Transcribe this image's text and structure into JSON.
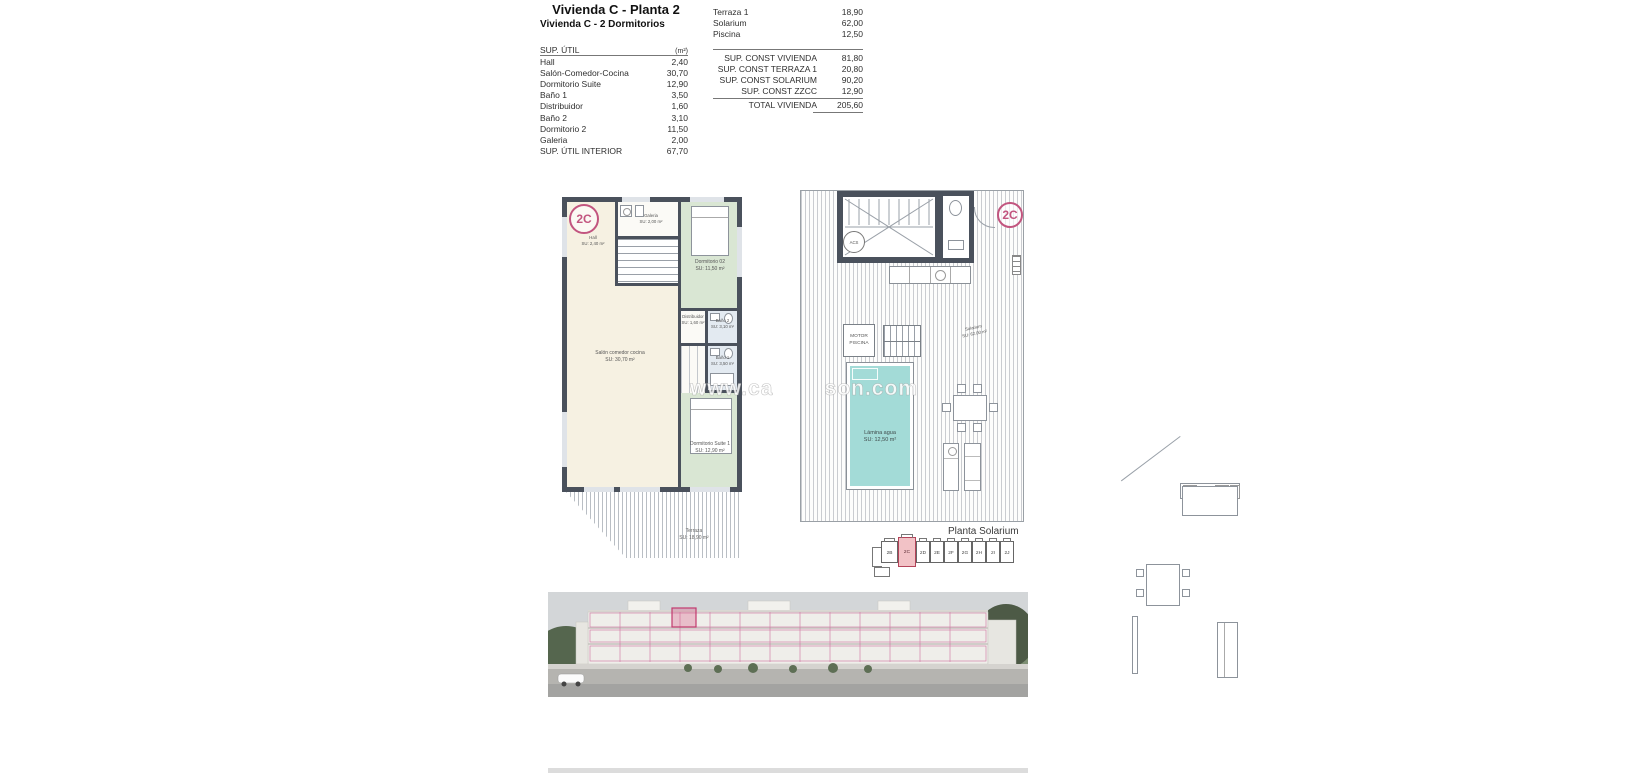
{
  "header": {
    "title": "Vivienda C - Planta 2",
    "subtitle": "Vivienda C - 2 Dormitorios"
  },
  "sup_util_table": {
    "header": {
      "label": "SUP. ÚTIL",
      "unit": "(m²)"
    },
    "rows": [
      {
        "label": "Hall",
        "value": "2,40"
      },
      {
        "label": "Salón-Comedor-Cocina",
        "value": "30,70"
      },
      {
        "label": "Dormitorio Suite",
        "value": "12,90"
      },
      {
        "label": "Baño 1",
        "value": "3,50"
      },
      {
        "label": "Distribuidor",
        "value": "1,60"
      },
      {
        "label": "Baño 2",
        "value": "3,10"
      },
      {
        "label": "Dormitorio 2",
        "value": "11,50"
      },
      {
        "label": "Galeria",
        "value": "2,00"
      },
      {
        "label": "SUP. ÚTIL INTERIOR",
        "value": "67,70"
      }
    ]
  },
  "exterior_table": {
    "rows": [
      {
        "label": "Terraza 1",
        "value": "18,90"
      },
      {
        "label": "Solarium",
        "value": "62,00"
      },
      {
        "label": "Piscina",
        "value": "12,50"
      }
    ]
  },
  "const_table": {
    "rows": [
      {
        "label": "SUP. CONST VIVIENDA",
        "value": "81,80"
      },
      {
        "label": "SUP. CONST TERRAZA 1",
        "value": "20,80"
      },
      {
        "label": "SUP. CONST SOLARIUM",
        "value": "90,20"
      },
      {
        "label": "SUP. CONST ZZCC",
        "value": "12,90"
      }
    ],
    "total": {
      "label": "TOTAL VIVIENDA",
      "value": "205,60"
    }
  },
  "floor_plan": {
    "unit_badge": "2C",
    "rooms": {
      "hall": {
        "name": "Hall",
        "area": "SU: 2,40 m²"
      },
      "galeria": {
        "name": "Galeria",
        "area": "SU: 2,00 m²"
      },
      "dormitorio2": {
        "name": "Dormitorio 02",
        "area": "SU: 11,50 m²"
      },
      "salon": {
        "name": "Salón comedor cocina",
        "area": "SU: 30,70 m²"
      },
      "distribuidor": {
        "name": "Distribuidor",
        "area": "SU: 1,60 m²"
      },
      "bano2": {
        "name": "Baño 2",
        "area": "SU: 3,10 m²"
      },
      "bano1": {
        "name": "Baño 1",
        "area": "SU: 3,50 m²"
      },
      "suite": {
        "name": "Dormitorio Suite 1",
        "area": "SU: 12,90 m²"
      },
      "terraza": {
        "name": "Terraza",
        "area": "SU: 18,90 m²"
      }
    }
  },
  "solarium_plan": {
    "unit_badge": "2C",
    "caption": "Planta Solarium",
    "labels": {
      "acs": "ACS",
      "motor_line1": "MOTOR",
      "motor_line2": "PISCINA",
      "pool_name": "Lámina agua",
      "pool_area": "SU:  12,50 m²",
      "solarium_name": "Solarium",
      "solarium_area": "SU: 62,00 m²"
    }
  },
  "key_plan": {
    "units": [
      "2B",
      "2C",
      "2D",
      "2E",
      "2F",
      "2G",
      "2H",
      "2I",
      "2J"
    ],
    "highlighted_unit": "2C"
  },
  "watermark": {
    "prefix": "www.ca",
    "suffix": "son.com"
  },
  "colors": {
    "accent_pink": "#c2557f",
    "wall_dark": "#4a515c",
    "room_cream": "#f6f1e2",
    "room_green": "#d9e6d3",
    "room_blue": "#e3eaf1",
    "pool_teal": "#a3dbd7",
    "keyplan_highlight": "#f2c2c6"
  }
}
